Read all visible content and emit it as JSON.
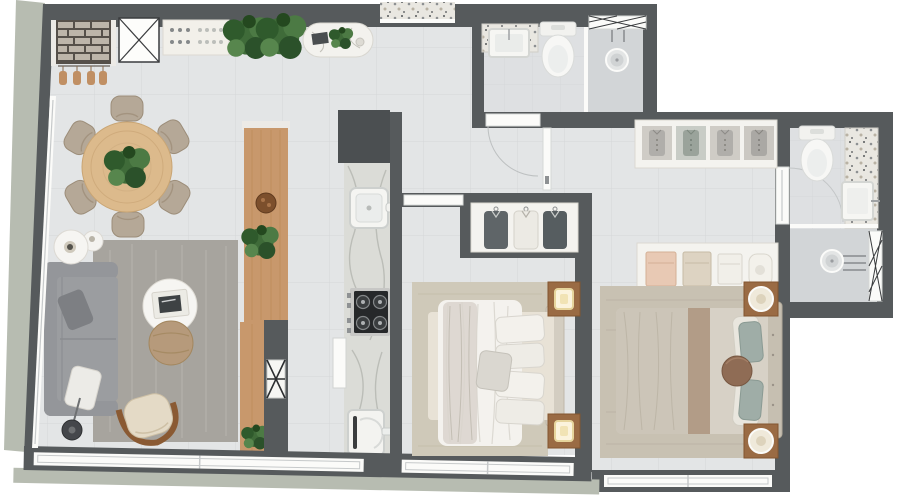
{
  "palette": {
    "wall": "#565a5c",
    "wall_dark": "#4b4f51",
    "floor": "#e3e5e6",
    "floor_line": "#d4d7d8",
    "bath_floor": "#dee0e2",
    "shower_floor": "#d2d5d7",
    "ledge": "#b7bcb1",
    "white": "#f7f7f5",
    "frame_line": "#c6c9ca",
    "wood": "#c8986c",
    "wood_dark": "#9a6b44",
    "wood_light": "#dcba8c",
    "marble": "#dbdcd7",
    "vein": "#b6b8b2",
    "terrazzo": "#e9e7e1",
    "rug_living": "#a7a49e",
    "rug_bed": "#cfc9b9",
    "rug_master": "#c8c1b2",
    "sofa": "#9b9da0",
    "sofa_dark": "#7d7f83",
    "cream": "#e7e0d2",
    "tan": "#b69a7b",
    "teal": "#9fada7",
    "bed_white": "#f3f2ee",
    "black": "#2a2c2e",
    "plant": "#3f6b39",
    "plant_dark": "#2f5a2c",
    "glow": "#fbf3dc"
  },
  "plan": {
    "type": "apartment-floor-plan-top-view",
    "rooms": [
      {
        "name": "living-dining-room"
      },
      {
        "name": "kitchen"
      },
      {
        "name": "entry-hall"
      },
      {
        "name": "bathroom-1"
      },
      {
        "name": "bedroom-1"
      },
      {
        "name": "master-suite-hall"
      },
      {
        "name": "master-bedroom"
      },
      {
        "name": "ensuite-bathroom"
      },
      {
        "name": "perimeter-ledge"
      }
    ],
    "furniture": [
      "dining-table",
      "dining-chair",
      "table-plant",
      "sofa",
      "living-rug",
      "coffee-table",
      "ottoman-pouf",
      "armchair",
      "floor-lamp",
      "side-table",
      "bbq-brick-grill",
      "shaft-x-box",
      "sideboard",
      "decor-plant",
      "oval-console",
      "entry-terrazzo",
      "kitchen-island",
      "island-plant",
      "kitchen-counter",
      "kitchen-sink",
      "cooktop",
      "fridge",
      "utility-appliance",
      "service-door-leaf",
      "shaft-x-marker",
      "vanity-counter",
      "vanity-sink",
      "toilet",
      "shower-glass",
      "shower-head",
      "lattice-window",
      "hall-wardrobe",
      "suite-shelves",
      "bedroom-wardrobe",
      "bed",
      "duvet",
      "pillow",
      "nightstand",
      "table-lamp",
      "bedroom-rug",
      "window",
      "door-threshold",
      "door-leaf"
    ]
  }
}
